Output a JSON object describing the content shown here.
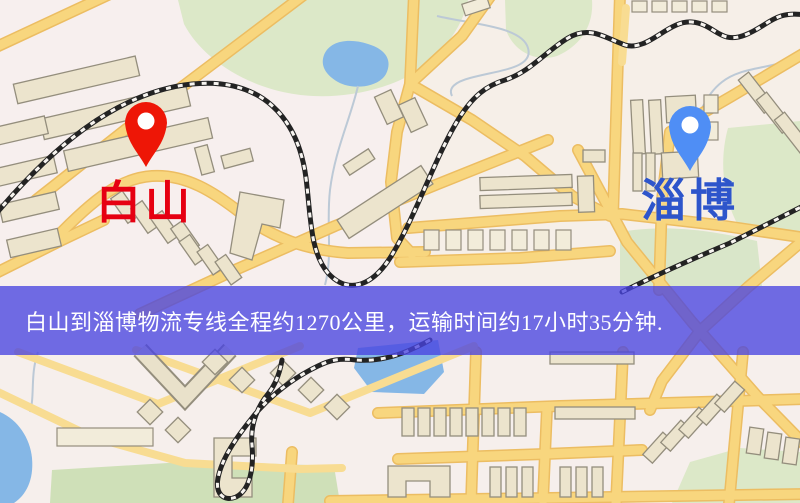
{
  "banner": {
    "text": "白山到淄博物流专线全程约1270公里，运输时间约17小时35分钟.",
    "background_color": "#4a45e0",
    "text_color": "#ffffff"
  },
  "markers": {
    "origin": {
      "label": "白山",
      "label_color": "#e60012",
      "pin_color": "#ee1606"
    },
    "destination": {
      "label": "淄博",
      "label_color": "#2e55cb",
      "pin_color": "#4f8ef5"
    }
  },
  "map_colors": {
    "background": "#f6efec",
    "road_fill": "#f8d67e",
    "road_casing": "#ecbd62",
    "park": "#dce8c8",
    "water": "#85b7e6",
    "building": "#ece4cd",
    "railway": "#232323"
  }
}
